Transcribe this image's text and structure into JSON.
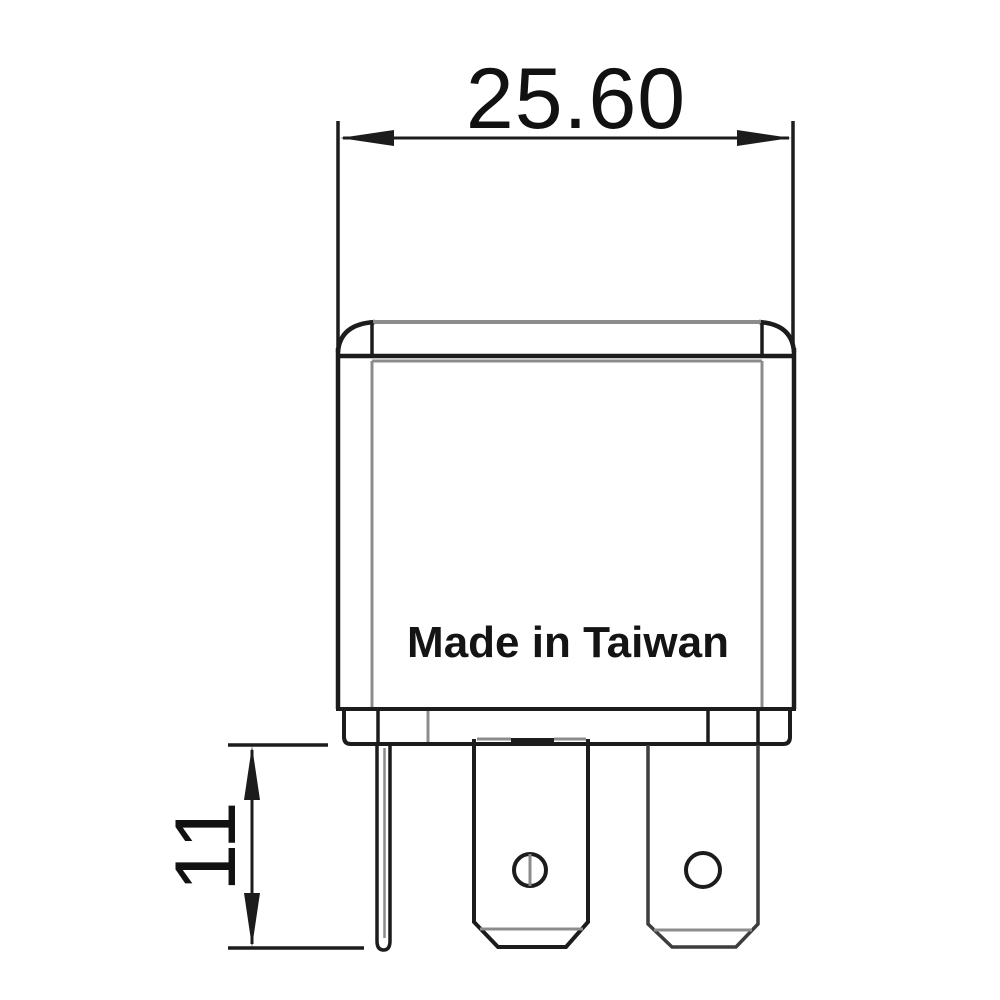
{
  "drawing": {
    "type": "technical-dimension-drawing",
    "subject": "mini relay package outline with blade terminals",
    "dimensions": {
      "width_label": "25.60",
      "height_label": "11"
    },
    "body_text": "Made in Taiwan",
    "colors": {
      "primary_line": "#1c1c1c",
      "secondary_line": "#8c8c8c",
      "text": "#111111",
      "background": "#ffffff"
    }
  }
}
